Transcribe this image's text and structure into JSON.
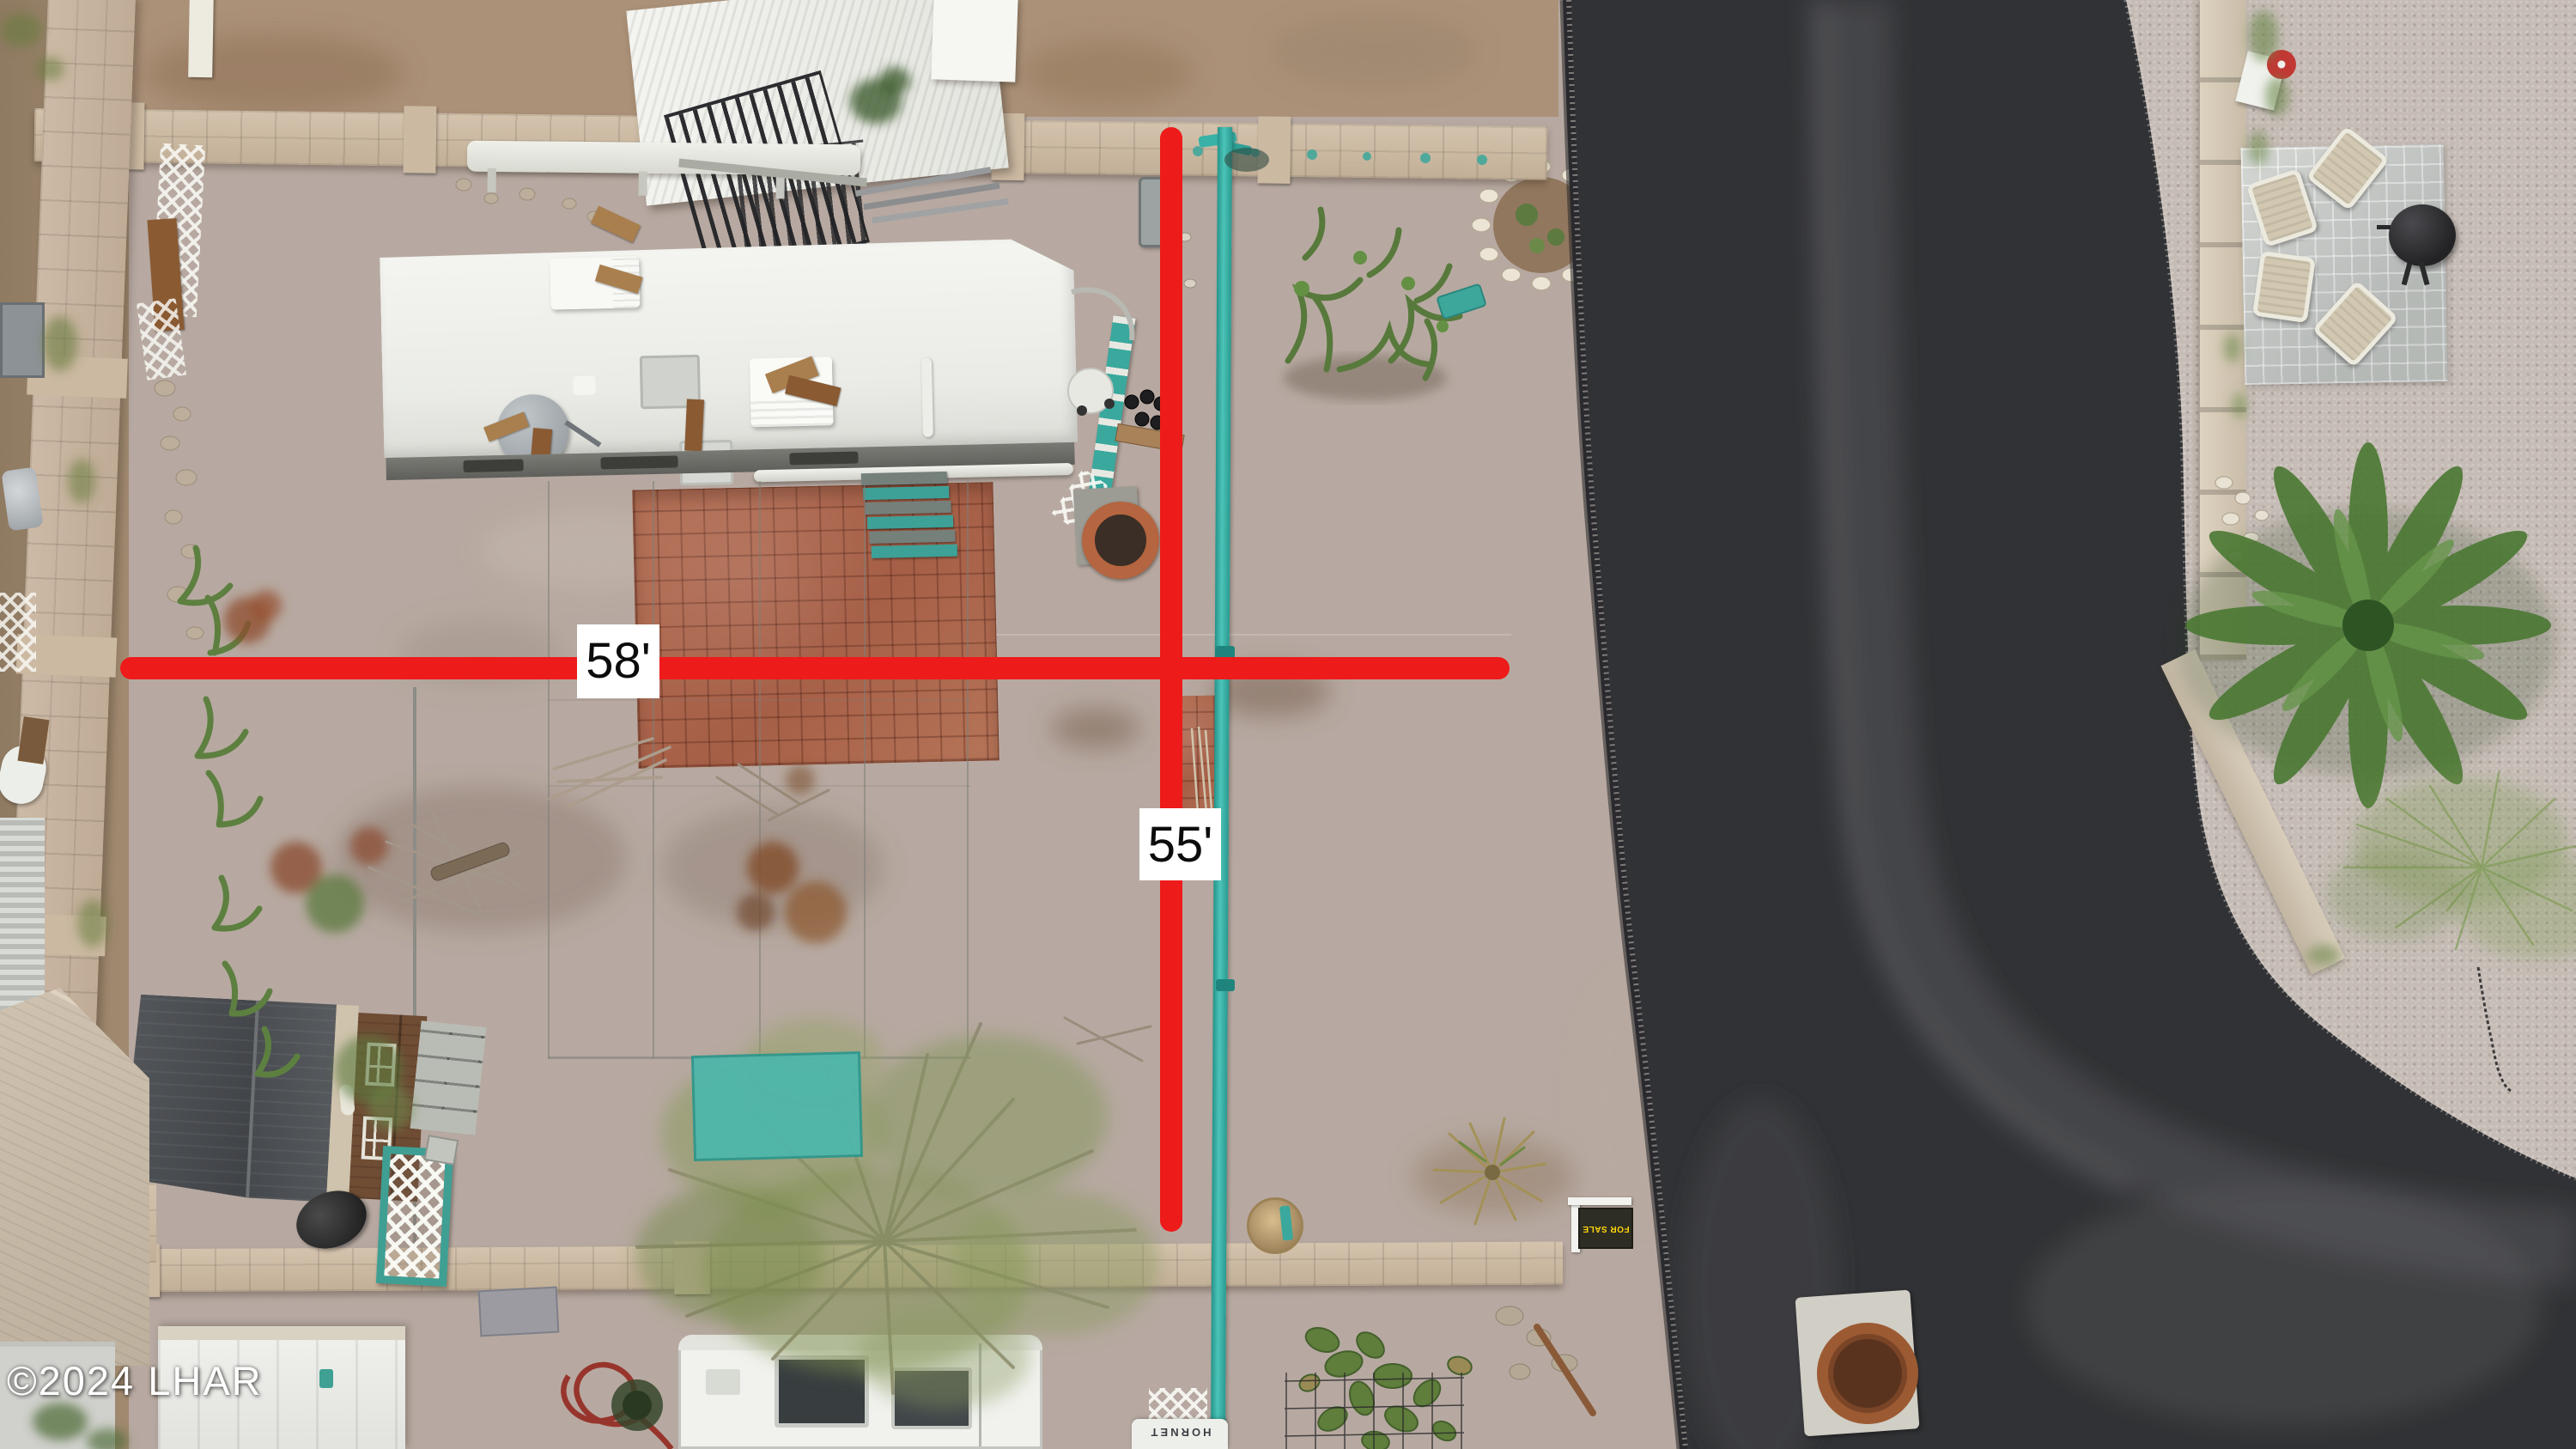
{
  "meta": {
    "title": "Aerial drone photo of residential lot with dimension overlay"
  },
  "annotations": {
    "horizontal_measurement": "58'",
    "vertical_measurement": "55'",
    "line_color": "#ee1b1b",
    "label_bg": "#ffffff",
    "label_text_color": "#0c0c0c"
  },
  "watermark": {
    "text": "©2024 LHAR",
    "color": "#ffffff"
  },
  "objects": {
    "for_sale_sign": {
      "text": "FOR SALE",
      "text_color": "#ffd60a",
      "bg": "#2e2d24"
    },
    "trailer_brand": {
      "text": "HORNET"
    }
  },
  "palette": {
    "lot_gravel": "#b7a9a1",
    "shoulder_gravel": "#d6cdc5",
    "neighbor_yard": "#ad947f",
    "road_asphalt": "#313235",
    "teal_pipe": "#38b2a7",
    "patio_brick": "#b06a52",
    "wall_tan": "#cdbba6",
    "shed_roof": "#45484c",
    "steps_teal": "#3da198"
  }
}
